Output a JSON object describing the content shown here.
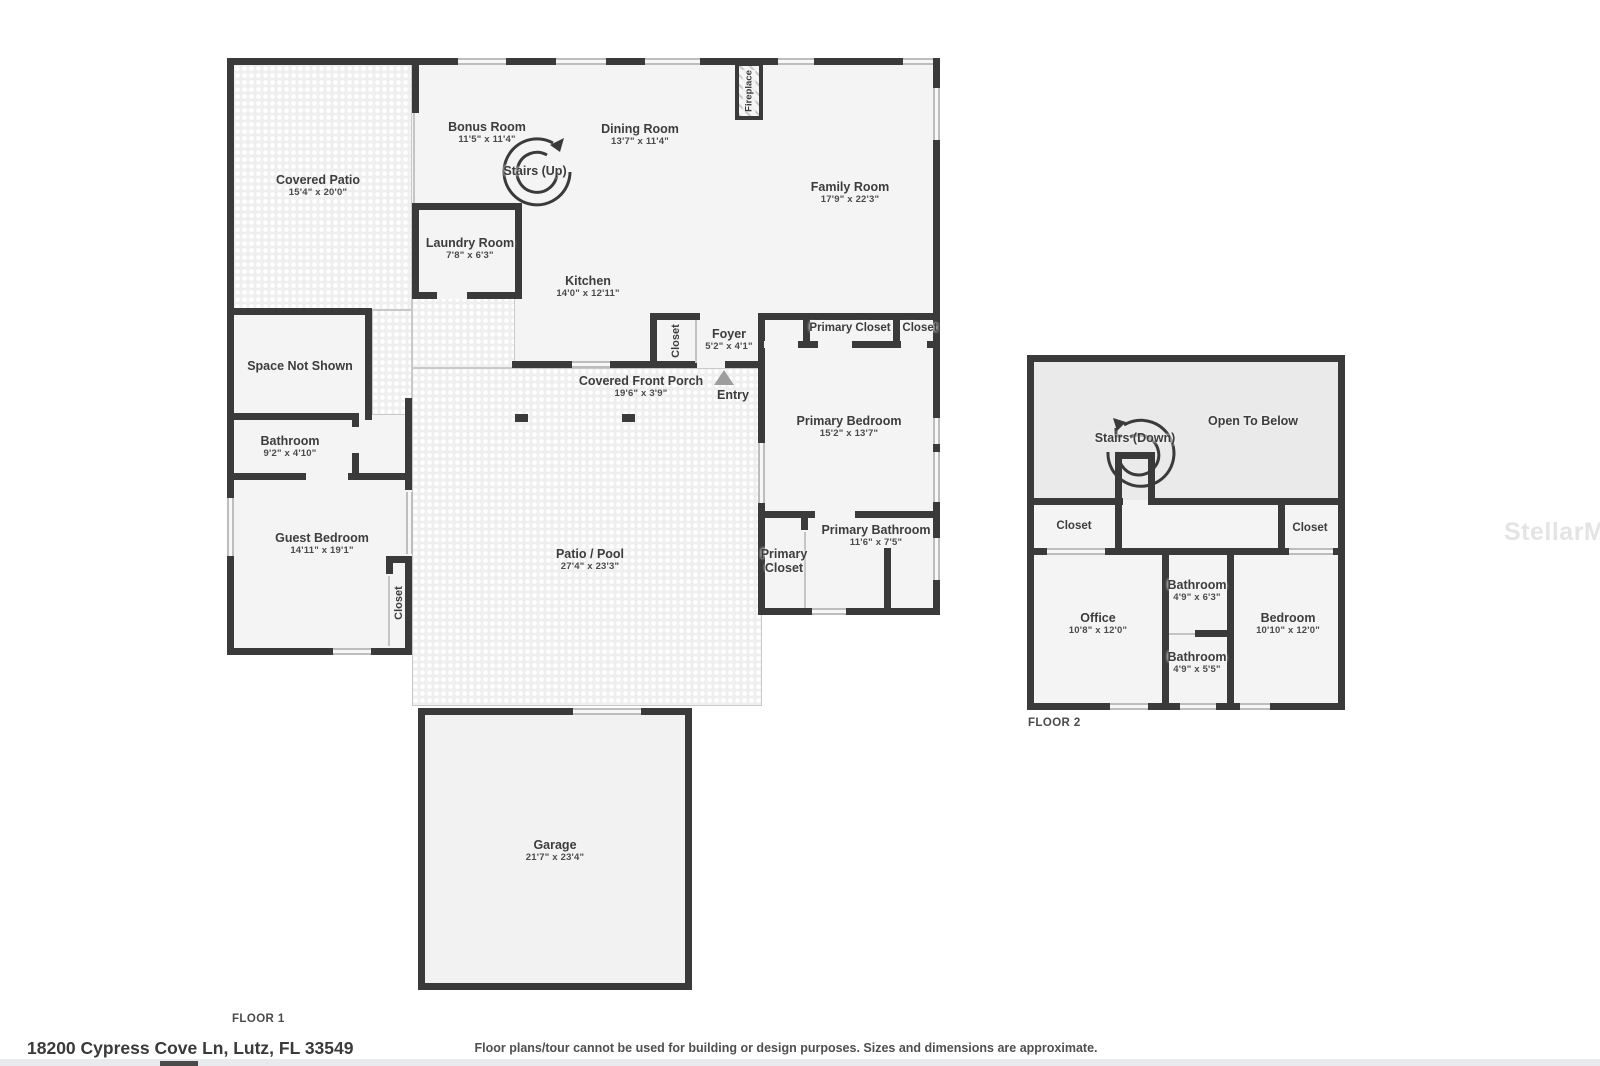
{
  "meta": {
    "address": "18200 Cypress Cove Ln, Lutz, FL 33549",
    "disclaimer": "Floor plans/tour cannot be used for building or design purposes. Sizes and dimensions are approximate.",
    "watermark": "StellarMLS",
    "wall_color": "#3a3a3a",
    "room_fill": "#f4f4f4"
  },
  "floor1": {
    "label": "FLOOR 1",
    "rooms": {
      "covered_patio": {
        "name": "Covered Patio",
        "dims": "15'4\" x 20'0\""
      },
      "bonus_room": {
        "name": "Bonus Room",
        "dims": "11'5\" x 11'4\""
      },
      "dining_room": {
        "name": "Dining Room",
        "dims": "13'7\" x 11'4\""
      },
      "family_room": {
        "name": "Family Room",
        "dims": "17'9\" x 22'3\""
      },
      "stairs_up": {
        "name": "Stairs (Up)"
      },
      "fireplace": {
        "name": "Fireplace"
      },
      "laundry_room": {
        "name": "Laundry Room",
        "dims": "7'8\" x 6'3\""
      },
      "kitchen": {
        "name": "Kitchen",
        "dims": "14'0\" x 12'11\""
      },
      "kitchen_closet": {
        "name": "Closet"
      },
      "foyer": {
        "name": "Foyer",
        "dims": "5'2\" x 4'1\""
      },
      "covered_front_porch": {
        "name": "Covered Front Porch",
        "dims": "19'6\" x 3'9\""
      },
      "entry": {
        "name": "Entry"
      },
      "primary_closet_top": {
        "name": "Primary Closet"
      },
      "hall_closet": {
        "name": "Closet"
      },
      "primary_bedroom": {
        "name": "Primary Bedroom",
        "dims": "15'2\" x 13'7\""
      },
      "primary_bathroom": {
        "name": "Primary Bathroom",
        "dims": "11'6\" x 7'5\""
      },
      "primary_closet": {
        "name": "Primary Closet"
      },
      "space_not_shown": {
        "name": "Space Not Shown"
      },
      "bathroom": {
        "name": "Bathroom",
        "dims": "9'2\" x 4'10\""
      },
      "guest_bedroom": {
        "name": "Guest Bedroom",
        "dims": "14'11\" x 19'1\""
      },
      "guest_closet": {
        "name": "Closet"
      },
      "patio_pool": {
        "name": "Patio / Pool",
        "dims": "27'4\" x 23'3\""
      },
      "garage": {
        "name": "Garage",
        "dims": "21'7\" x 23'4\""
      }
    }
  },
  "floor2": {
    "label": "FLOOR 2",
    "rooms": {
      "open_to_below": {
        "name": "Open To Below"
      },
      "stairs_down": {
        "name": "Stairs (Down)"
      },
      "closet_left": {
        "name": "Closet"
      },
      "closet_right": {
        "name": "Closet"
      },
      "office": {
        "name": "Office",
        "dims": "10'8\" x 12'0\""
      },
      "bathroom_upper": {
        "name": "Bathroom",
        "dims": "4'9\" x 6'3\""
      },
      "bathroom_lower": {
        "name": "Bathroom",
        "dims": "4'9\" x 5'5\""
      },
      "bedroom": {
        "name": "Bedroom",
        "dims": "10'10\" x 12'0\""
      }
    }
  }
}
